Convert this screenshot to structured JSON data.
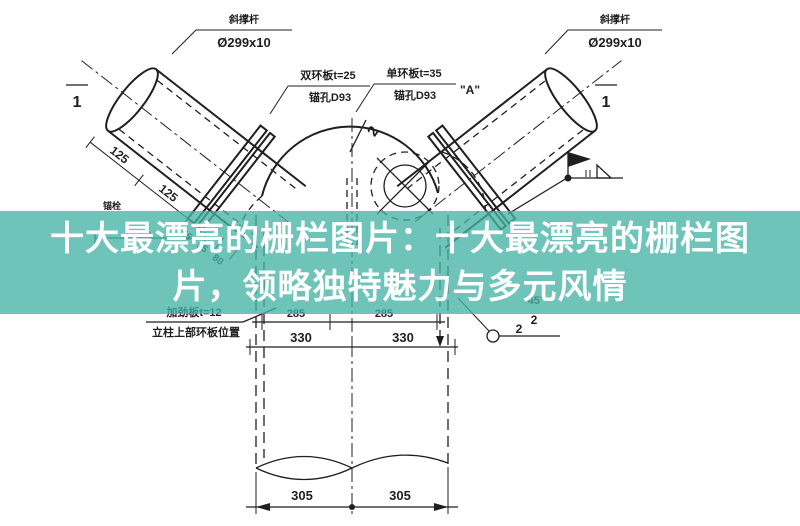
{
  "banner": {
    "line1": "十大最漂亮的栅栏图片：十大最漂亮的栅栏图",
    "line2": "片，领略独特魅力与多元风情",
    "background_hex": "#46b4a6",
    "background_rgba": "rgba(70,180,166,0.78)",
    "text_color": "#ffffff"
  },
  "drawing": {
    "ink_color": "#1f1f1f",
    "callout_left": {
      "title": "斜撑杆",
      "spec": "Ø299x10"
    },
    "callout_right": {
      "title": "斜撑杆",
      "spec": "Ø299x10"
    },
    "label_ring_left": {
      "line1": "双环板t=25",
      "line2": "锚孔D93"
    },
    "label_ring_right": {
      "line1": "单环板t=35",
      "line2": "锚孔D93",
      "detail": "\"A\""
    },
    "label_plate": {
      "line1": "加劲板t=12",
      "line2": "立柱上部环板位置"
    },
    "label_small": "锚栓",
    "section_left": "1",
    "section_right": "1",
    "slope_mark": "2",
    "angle_mark": "45°",
    "weld_numbers": [
      "2",
      "2"
    ],
    "dims": {
      "pipe_left": [
        "125",
        "125",
        "55",
        "95",
        "80"
      ],
      "row_a": [
        "285",
        "285"
      ],
      "row_b": [
        "330",
        "330"
      ],
      "row_bottom": [
        "305",
        "305"
      ]
    }
  }
}
